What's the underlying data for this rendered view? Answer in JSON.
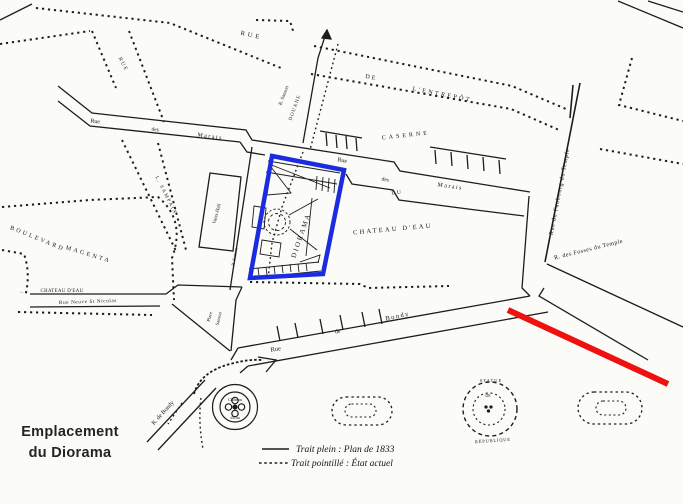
{
  "colors": {
    "blue": "#1b2be0",
    "red": "#ef1010",
    "ink": "#1d1d1d",
    "paper": "#fbfbf8"
  },
  "caption": {
    "line1": "Emplacement",
    "line2": "du Diorama"
  },
  "legend": {
    "solid": "Trait plein : Plan de 1833",
    "dotted": "Trait pointillé : État actuel"
  },
  "labels": {
    "entrepot": {
      "rue": "RUE",
      "de": "DE",
      "name": "L'ENTREPÔT"
    },
    "rue_small": "RUE",
    "sampaix": "L. SAMPAIX",
    "marais_w": {
      "rue": "Rue",
      "des": "des",
      "name": "Marais"
    },
    "marais_e": {
      "rue": "Rue",
      "des": "des",
      "name": "Marais"
    },
    "sanson": "R. Sanson",
    "douane": "DOUANE",
    "sanson_s": "R. Sanson",
    "caserne": "CASERNE",
    "du": "DU",
    "chateau_deau": "CHATEAU D'EAU",
    "vauxhall": "Vaux-Hall",
    "boulevard": "BOULEVARD",
    "magenta": "MAGENTA",
    "arrow": "←",
    "chateau_small": "CHATEAU D'EAU",
    "rue_neuve": "Rue Neuve St Nicolas",
    "diorama": "DIORAMA",
    "place": "Place",
    "place_sanson": "Sanson",
    "bondy": {
      "rue": "Rue",
      "de": "de",
      "name": "Bondy"
    },
    "r_de_bondy": "R. de Bondy",
    "fountain": {
      "top": "Château",
      "bottom": "d'Eau"
    },
    "faubourg": "Rue du Faubourg du Temple",
    "fosses": "R. des Fosses du Temple",
    "statue": "STATUE",
    "statue_de": "DE",
    "republique": "RÉPUBLIQUE"
  }
}
